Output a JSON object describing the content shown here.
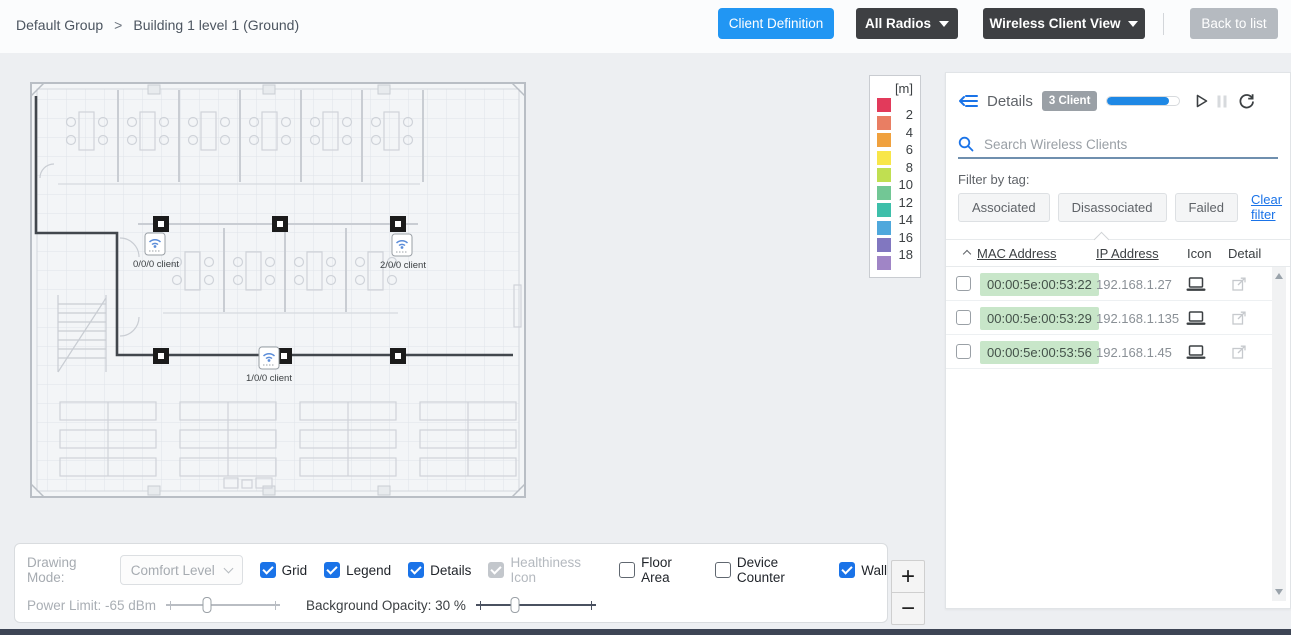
{
  "colors": {
    "accent_blue": "#2196f3",
    "link_blue": "#1a73e8",
    "dark_button": "#3e4043",
    "gray_button": "#b5bac0",
    "mac_highlight": "#c8e6c9",
    "search_underline": "#6f8fae",
    "bottom_strip": "#3d4555"
  },
  "breadcrumb": {
    "group": "Default Group",
    "separator": ">",
    "location": "Building 1 level 1 (Ground)"
  },
  "topbar": {
    "client_definition": "Client Definition",
    "all_radios": "All Radios",
    "wireless_client_view": "Wireless Client View",
    "back_to_list": "Back to list"
  },
  "legend": {
    "unit": "[m]",
    "labels": [
      "2",
      "4",
      "6",
      "8",
      "10",
      "12",
      "14",
      "16",
      "18"
    ],
    "colors": [
      "#e23a5b",
      "#e97e63",
      "#f0a13e",
      "#f8e649",
      "#c0df51",
      "#72c795",
      "#3ebfaa",
      "#4fa8dc",
      "#8177c0",
      "#a085c6"
    ]
  },
  "floorplan": {
    "aps": [
      {
        "label": "0/0/0 client"
      },
      {
        "label": "1/0/0 client"
      },
      {
        "label": "2/0/0 client"
      }
    ]
  },
  "details_panel": {
    "title": "Details",
    "badge": "3 Client",
    "progress_percent": 85,
    "search_placeholder": "Search Wireless Clients",
    "filter_label": "Filter by tag:",
    "filters": [
      "Associated",
      "Disassociated",
      "Failed"
    ],
    "clear_filter": "Clear filter",
    "table": {
      "headers": {
        "mac": "MAC Address",
        "ip": "IP Address",
        "icon": "Icon",
        "detail": "Detail"
      },
      "rows": [
        {
          "mac": "00:00:5e:00:53:22",
          "ip": "192.168.1.27"
        },
        {
          "mac": "00:00:5e:00:53:29",
          "ip": "192.168.1.135"
        },
        {
          "mac": "00:00:5e:00:53:56",
          "ip": "192.168.1.45"
        }
      ]
    }
  },
  "toolbar": {
    "drawing_mode_label": "Drawing Mode:",
    "drawing_mode_value": "Comfort Level",
    "checkboxes": [
      {
        "label": "Grid",
        "checked": true,
        "disabled": false
      },
      {
        "label": "Legend",
        "checked": true,
        "disabled": false
      },
      {
        "label": "Details",
        "checked": true,
        "disabled": false
      },
      {
        "label": "Healthiness Icon",
        "checked": true,
        "disabled": true
      },
      {
        "label": "Floor Area",
        "checked": false,
        "disabled": false
      },
      {
        "label": "Device Counter",
        "checked": false,
        "disabled": false
      },
      {
        "label": "Wall",
        "checked": true,
        "disabled": false
      }
    ],
    "power_limit_label": "Power Limit: -65 dBm",
    "power_limit_percent": 33,
    "background_opacity_label": "Background Opacity: 30 %",
    "background_opacity_percent": 30
  },
  "zoom_controls": {
    "zoom_in": "+",
    "zoom_out": "−"
  }
}
